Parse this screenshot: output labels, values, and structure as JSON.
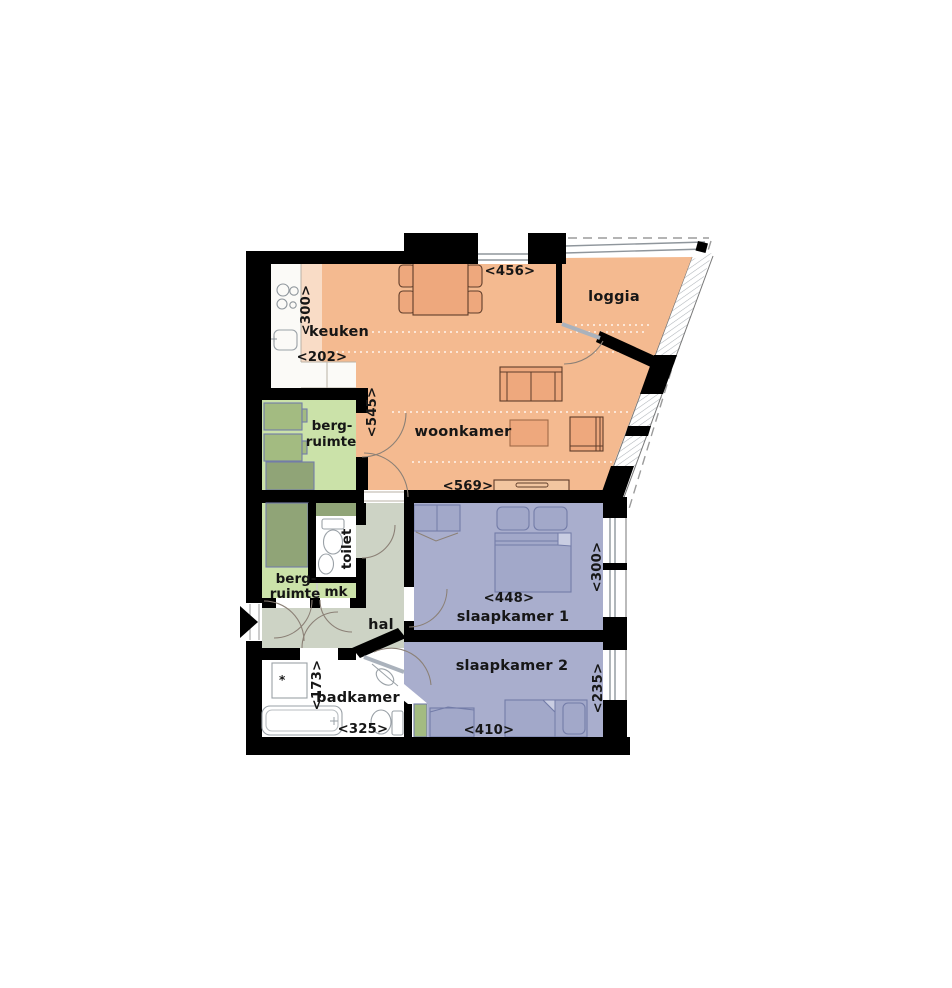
{
  "title": "apartment-floor-plan",
  "labels": {
    "keuken": "keuken",
    "loggia": "loggia",
    "woonkamer": "woonkamer",
    "berg1_line1": "berg-",
    "berg1_line2": "ruimte",
    "berg2_line1": "berg-",
    "berg2_line2": "ruimte",
    "toilet": "toilet",
    "mk": "mk",
    "hal": "hal",
    "slaapkamer1": "slaapkamer 1",
    "slaapkamer2": "slaapkamer 2",
    "badkamer": "badkamer"
  },
  "dimensions": {
    "keuken_width": "<300>",
    "keuken_depth": "<202>",
    "woonkamer_top": "<456>",
    "woonkamer_left": "<545>",
    "woonkamer_bottom": "<569>",
    "slaapkamer1_width": "<448>",
    "slaapkamer1_depth": "<300>",
    "slaapkamer2_width": "<410>",
    "slaapkamer2_depth": "<235>",
    "badkamer_depth": "<173>",
    "badkamer_width": "<325>"
  },
  "colors": {
    "wall": "#000000",
    "living_peach": "#f4ba90",
    "kitchen_light": "#f9dcc6",
    "furniture_orange": "#eea87d",
    "sideboard_light": "#f2c6a0",
    "storage_green_light": "#cbe2a9",
    "cabinet_green": "#a3bb81",
    "cabinet_green_dark": "#90a477",
    "hall_gray_green": "#cdd3c5",
    "bedroom_purple": "#a9aecd",
    "bedroom_furniture": "#a2a8c9",
    "white": "#ffffff"
  },
  "icons": {
    "entrance_arrow": "entrance direction arrow",
    "shower_drain": "*",
    "tub_drain": "+"
  }
}
